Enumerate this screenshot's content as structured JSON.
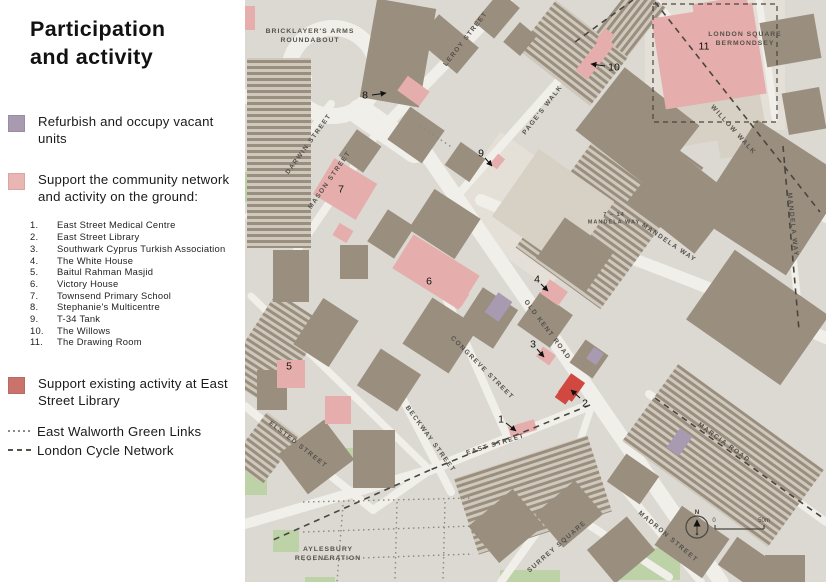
{
  "title": "Participation and activity",
  "legend": {
    "refurbish": {
      "label": "Refurbish and occupy vacant units",
      "color": "#a89ab0"
    },
    "community": {
      "label": "Support the community network and activity on the ground:",
      "color": "#e9b6b4"
    },
    "community_items": [
      "East Street Medical Centre",
      "East Street Library",
      "Southwark Cyprus Turkish Association",
      "The White House",
      "Baitul Rahman Masjid",
      "Victory House",
      "Townsend Primary School",
      "Stephanie's Multicentre",
      "T-34 Tank",
      "The Willows",
      "The Drawing Room"
    ],
    "existing": {
      "label": "Support existing activity at East Street Library",
      "color": "#c9736c"
    },
    "green_links_label": "East Walworth Green Links",
    "cycle_network_label": "London Cycle Network"
  },
  "map": {
    "width": 581,
    "height": 582,
    "colors": {
      "bg": "#dbd9d2",
      "road": "#f1efe9",
      "building": "#9a8e7f",
      "beige": "#d7d1c5",
      "light": "#e4e0d7",
      "green": "#bdd2a6",
      "green2": "#cfdfbc",
      "pink": "#e5aeac",
      "purple": "#a89ab0",
      "red": "#d04840",
      "dash": "#4a463f",
      "dots": "#8d8880",
      "label": "#55514b",
      "marker": "#111111",
      "hatch_bg": "#cfc9bd"
    },
    "light_parcels": [
      [
        215,
        160,
        130,
        100,
        35
      ],
      [
        400,
        0,
        140,
        130,
        0
      ]
    ],
    "roads": {
      "circles": [
        [
          88,
          72,
          44,
          16
        ]
      ],
      "lines": [
        [
          0,
          97,
          60,
          78,
          14
        ],
        [
          115,
          112,
          170,
          150,
          26
        ],
        [
          138,
          128,
          262,
          0,
          11
        ],
        [
          165,
          130,
          476,
          582,
          15
        ],
        [
          196,
          214,
          378,
          8,
          8
        ],
        [
          408,
          0,
          581,
          218,
          10
        ],
        [
          536,
          142,
          556,
          332,
          7
        ],
        [
          4,
          216,
          86,
          104,
          8
        ],
        [
          44,
          262,
          138,
          124,
          8
        ],
        [
          198,
          291,
          262,
          436,
          8
        ],
        [
          148,
          380,
          206,
          492,
          8
        ],
        [
          0,
          524,
          185,
          470,
          10
        ],
        [
          185,
          470,
          348,
          404,
          10
        ],
        [
          0,
          406,
          128,
          510,
          8
        ],
        [
          128,
          510,
          185,
          470,
          8
        ],
        [
          6,
          296,
          185,
          470,
          7
        ],
        [
          256,
          582,
          312,
          504,
          8
        ],
        [
          312,
          504,
          424,
          577,
          8
        ],
        [
          316,
          498,
          346,
          408,
          7
        ],
        [
          380,
          490,
          456,
          582,
          8
        ],
        [
          404,
          394,
          581,
          522,
          8
        ],
        [
          514,
          0,
          530,
          118,
          7
        ]
      ],
      "curves": [
        {
          "d": "M236,200 C330,240 430,270 581,338",
          "w": 12
        }
      ]
    },
    "terraces": [
      [
        2,
        58,
        64,
        190,
        0
      ],
      [
        312,
        120,
        105,
        175,
        36
      ],
      [
        282,
        22,
        92,
        62,
        38
      ],
      [
        388,
        408,
        180,
        95,
        36
      ],
      [
        218,
        455,
        140,
        80,
        -18
      ],
      [
        355,
        0,
        62,
        40,
        -52
      ],
      [
        0,
        418,
        40,
        60,
        37
      ],
      [
        0,
        300,
        58,
        100,
        33
      ]
    ],
    "buildings": [
      [
        123,
        3,
        60,
        100,
        10
      ],
      [
        186,
        18,
        34,
        52,
        -50
      ],
      [
        232,
        2,
        40,
        26,
        -50
      ],
      [
        262,
        28,
        26,
        22,
        -50
      ],
      [
        345,
        88,
        95,
        80,
        38
      ],
      [
        395,
        165,
        85,
        70,
        38
      ],
      [
        472,
        140,
        109,
        115,
        33
      ],
      [
        455,
        275,
        115,
        85,
        35
      ],
      [
        300,
        230,
        60,
        50,
        35
      ],
      [
        518,
        18,
        55,
        45,
        -10
      ],
      [
        540,
        90,
        38,
        42,
        -10
      ],
      [
        150,
        115,
        42,
        40,
        35
      ],
      [
        100,
        135,
        30,
        32,
        35
      ],
      [
        172,
        200,
        55,
        48,
        33
      ],
      [
        130,
        215,
        32,
        38,
        33
      ],
      [
        95,
        245,
        28,
        34,
        0
      ],
      [
        222,
        295,
        42,
        46,
        33
      ],
      [
        168,
        308,
        55,
        55,
        33
      ],
      [
        120,
        358,
        48,
        44,
        33
      ],
      [
        28,
        250,
        36,
        52,
        0
      ],
      [
        60,
        305,
        42,
        55,
        33
      ],
      [
        42,
        432,
        58,
        50,
        -37
      ],
      [
        108,
        430,
        42,
        58,
        0
      ],
      [
        12,
        370,
        30,
        40,
        0
      ],
      [
        232,
        502,
        58,
        48,
        -40
      ],
      [
        298,
        492,
        52,
        44,
        -40
      ],
      [
        350,
        528,
        52,
        44,
        -40
      ],
      [
        418,
        518,
        58,
        48,
        35
      ],
      [
        478,
        548,
        50,
        34,
        35
      ],
      [
        368,
        462,
        40,
        34,
        35
      ],
      [
        205,
        148,
        30,
        28,
        35
      ],
      [
        280,
        300,
        40,
        40,
        35
      ],
      [
        330,
        345,
        28,
        28,
        35
      ],
      [
        520,
        555,
        40,
        27,
        0
      ]
    ],
    "beige_buildings": [
      [
        262,
        168,
        92,
        82,
        35
      ],
      [
        428,
        98,
        55,
        45,
        -10
      ],
      [
        470,
        95,
        50,
        60,
        -10
      ]
    ],
    "greens": [
      [
        0,
        172,
        24,
        30,
        0
      ],
      [
        32,
        262,
        28,
        34,
        0
      ],
      [
        0,
        455,
        22,
        40,
        0
      ],
      [
        28,
        530,
        26,
        22,
        0
      ],
      [
        98,
        448,
        16,
        12,
        0
      ],
      [
        255,
        570,
        60,
        12,
        0
      ],
      [
        375,
        548,
        60,
        32,
        0
      ],
      [
        60,
        577,
        30,
        5,
        0
      ]
    ],
    "pink_buildings": [
      [
        75,
        168,
        50,
        42,
        31
      ],
      [
        90,
        226,
        16,
        14,
        31
      ],
      [
        152,
        252,
        78,
        40,
        32
      ],
      [
        196,
        286,
        26,
        16,
        32
      ],
      [
        155,
        82,
        27,
        18,
        36
      ],
      [
        246,
        157,
        13,
        9,
        -50
      ],
      [
        328,
        50,
        44,
        15,
        -52
      ],
      [
        352,
        32,
        16,
        12,
        -52
      ],
      [
        413,
        10,
        102,
        92,
        -9
      ],
      [
        448,
        0,
        55,
        14,
        -9
      ],
      [
        298,
        284,
        22,
        17,
        35
      ],
      [
        264,
        423,
        27,
        11,
        -17
      ],
      [
        32,
        360,
        28,
        28,
        0
      ],
      [
        80,
        396,
        26,
        28,
        0
      ],
      [
        0,
        6,
        10,
        24,
        0
      ],
      [
        293,
        350,
        16,
        12,
        35
      ]
    ],
    "purple_buildings": [
      [
        245,
        295,
        17,
        24,
        35
      ],
      [
        344,
        349,
        12,
        14,
        35
      ],
      [
        427,
        430,
        15,
        24,
        35
      ]
    ],
    "red_buildings": [
      [
        318,
        376,
        17,
        23,
        35
      ],
      [
        312,
        390,
        13,
        12,
        35
      ]
    ],
    "boundary": [
      408,
      4,
      124,
      118
    ],
    "cycle_routes": [
      [
        410,
        2,
        575,
        212
      ],
      [
        345,
        405,
        185,
        470
      ],
      [
        185,
        470,
        28,
        540
      ],
      [
        410,
        398,
        578,
        518
      ],
      [
        330,
        42,
        388,
        0
      ],
      [
        538,
        146,
        554,
        330
      ]
    ],
    "green_links": [
      [
        175,
        126,
        208,
        148
      ],
      [
        58,
        502,
        228,
        498
      ],
      [
        98,
        505,
        92,
        582
      ],
      [
        152,
        502,
        150,
        582
      ],
      [
        58,
        532,
        228,
        526
      ],
      [
        200,
        502,
        198,
        582
      ],
      [
        58,
        560,
        228,
        554
      ]
    ],
    "street_labels": [
      {
        "t": "LEROY STREET",
        "x": 222,
        "y": 40,
        "r": -52
      },
      {
        "t": "PAGE'S WALK",
        "x": 299,
        "y": 111,
        "r": -52
      },
      {
        "t": "WILLOW WALK",
        "x": 487,
        "y": 131,
        "r": 48
      },
      {
        "t": "DARWIN STREET",
        "x": 65,
        "y": 145,
        "r": -54
      },
      {
        "t": "MASON STREET",
        "x": 86,
        "y": 181,
        "r": -55
      },
      {
        "t": "MANDELA WAY",
        "x": 423,
        "y": 244,
        "r": 34
      },
      {
        "t": "MANDELA WAY",
        "x": 546,
        "y": 225,
        "r": 84
      },
      {
        "t": "OLD KENT ROAD",
        "x": 301,
        "y": 331,
        "r": 53
      },
      {
        "t": "CONGREVE STREET",
        "x": 236,
        "y": 369,
        "r": 45
      },
      {
        "t": "BECKWAY STREET",
        "x": 184,
        "y": 440,
        "r": 54
      },
      {
        "t": "EAST STREET",
        "x": 251,
        "y": 446,
        "r": -17
      },
      {
        "t": "ELSTED STREET",
        "x": 52,
        "y": 446,
        "r": 38
      },
      {
        "t": "SURREY SQUARE",
        "x": 313,
        "y": 548,
        "r": -41
      },
      {
        "t": "MADRON STREET",
        "x": 422,
        "y": 538,
        "r": 40
      },
      {
        "t": "MARCIA ROAD",
        "x": 478,
        "y": 444,
        "r": 36
      }
    ],
    "area_labels": [
      {
        "lines": [
          "BRICKLAYER'S ARMS",
          "ROUNDABOUT"
        ],
        "x": 65,
        "y": 33,
        "size": 6.8
      },
      {
        "lines": [
          "LONDON SQUARE",
          "BERMONDSEY"
        ],
        "x": 500,
        "y": 36,
        "size": 6.8
      },
      {
        "lines": [
          "7 – 14",
          "MANDELA WAY"
        ],
        "x": 369,
        "y": 216,
        "size": 5.6
      },
      {
        "lines": [
          "AYLESBURY",
          "REGENERATION"
        ],
        "x": 83,
        "y": 551,
        "size": 6.8
      }
    ],
    "markers": [
      {
        "n": "1",
        "x": 256,
        "y": 419,
        "sx": 261,
        "sy": 423,
        "tx": 271,
        "ty": 431
      },
      {
        "n": "2",
        "x": 340,
        "y": 403,
        "sx": 335,
        "sy": 398,
        "tx": 326,
        "ty": 390
      },
      {
        "n": "3",
        "x": 288,
        "y": 344,
        "sx": 292,
        "sy": 349,
        "tx": 299,
        "ty": 357
      },
      {
        "n": "4",
        "x": 292,
        "y": 279,
        "sx": 296,
        "sy": 284,
        "tx": 303,
        "ty": 291
      },
      {
        "n": "5",
        "x": 44,
        "y": 366
      },
      {
        "n": "6",
        "x": 184,
        "y": 281
      },
      {
        "n": "7",
        "x": 96,
        "y": 189
      },
      {
        "n": "8",
        "x": 120,
        "y": 95,
        "sx": 127,
        "sy": 95,
        "tx": 141,
        "ty": 93
      },
      {
        "n": "9",
        "x": 236,
        "y": 153,
        "sx": 240,
        "sy": 158,
        "tx": 247,
        "ty": 166
      },
      {
        "n": "10",
        "x": 369,
        "y": 67,
        "sx": 360,
        "sy": 66,
        "tx": 346,
        "ty": 64
      },
      {
        "n": "11",
        "x": 459,
        "y": 46
      }
    ],
    "compass": {
      "x": 452,
      "y": 527,
      "label": "N"
    },
    "scalebar": {
      "x1": 470,
      "x2": 519,
      "y": 529,
      "zero": "0",
      "label": "50m"
    }
  }
}
